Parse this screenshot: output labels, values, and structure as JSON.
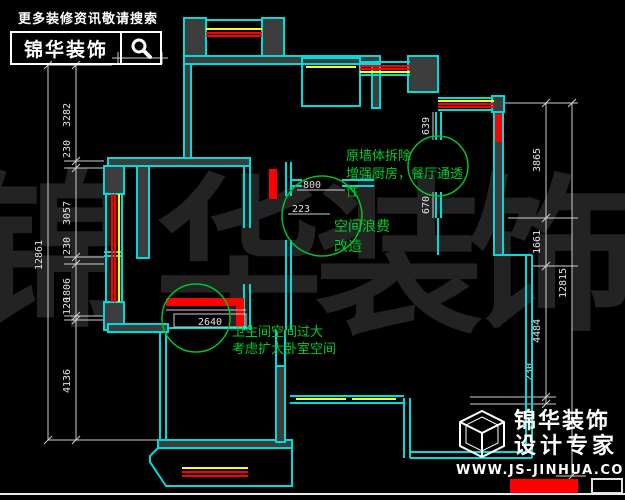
{
  "banner": {
    "tagline": "更多装修资讯敬请搜索",
    "brand": "锦华装饰",
    "search_icon": "magnifier-icon"
  },
  "watermark": {
    "chars": [
      "锦",
      "华",
      "装",
      "饰"
    ]
  },
  "logo": {
    "brand": "锦华装饰",
    "subtitle": "设计专家",
    "url": "WWW.JS-JINHUA.COM",
    "icon": "cube-logo-icon"
  },
  "dimensions": {
    "left_total": "12861",
    "left_segments": [
      "3282",
      "230",
      "3057",
      "230",
      "1806",
      "120",
      "4136"
    ],
    "right_total": "12815",
    "right_segments": [
      "3865",
      "1661",
      "4484",
      "230"
    ],
    "interior": {
      "door_width": "800",
      "door_offset": "223",
      "bath_width": "2640",
      "wall_upper": "639",
      "wall_lower": "670"
    }
  },
  "annotations": [
    {
      "lines": [
        "原墙体拆除",
        "增强厨房，餐厅通透",
        "性"
      ]
    },
    {
      "lines": [
        "空间浪费",
        "改造"
      ]
    },
    {
      "lines": [
        "卫生间空间过大",
        "考虑扩大卧室空间"
      ]
    }
  ],
  "colors": {
    "wall": "#00dcdc",
    "wall_fill": "#3d3d3d",
    "window_red": "#ff0000",
    "window_yellow": "#ffff00",
    "annotation_green": "#00cc2e",
    "dimension": "#d8d8d8",
    "watermark": "#232323"
  }
}
